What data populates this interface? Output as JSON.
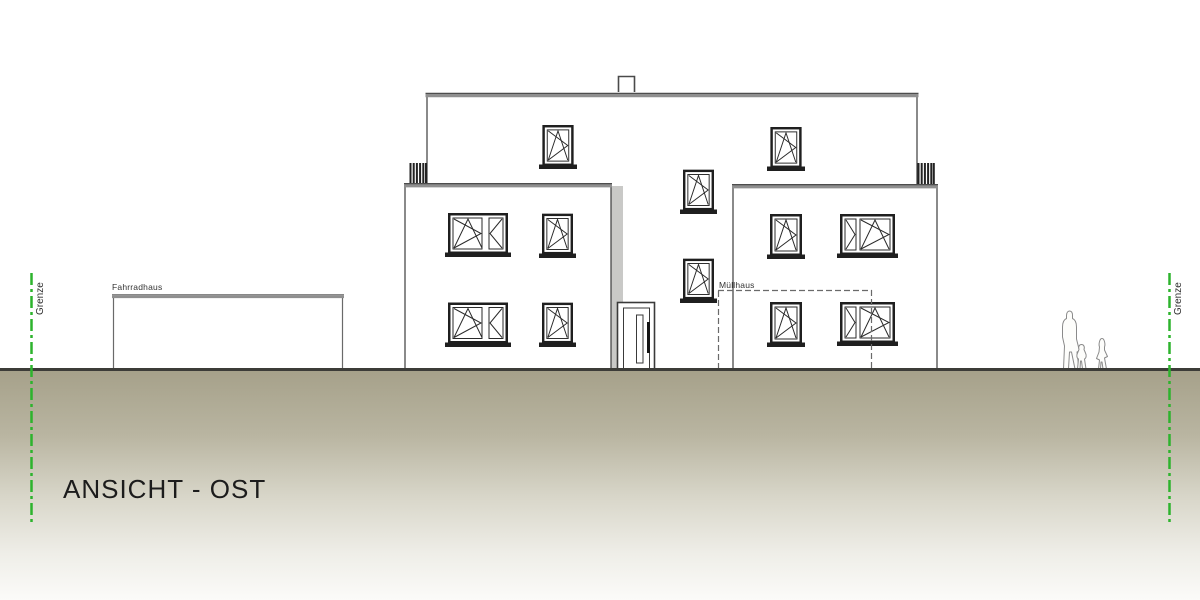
{
  "title": {
    "text": "ANSICHT - OST"
  },
  "labels": {
    "grenze_left": "Grenze",
    "grenze_right": "Grenze",
    "fahrradhaus": "Fahrradhaus",
    "muellhaus": "Müllhaus"
  },
  "colors": {
    "boundary_green": "#2db32d",
    "ground_tan": "#a6a18a",
    "roof_gray": "#8f8f8f",
    "line_dark": "#2f2f2f",
    "shadow_gray": "#c9c9c7"
  }
}
